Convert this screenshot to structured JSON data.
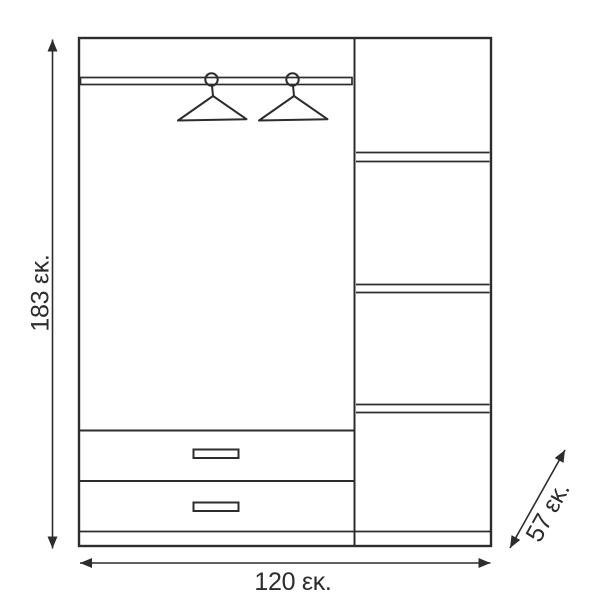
{
  "page": {
    "background_color": "#ffffff",
    "line_color": "#2d2d2d"
  },
  "diagram": {
    "type": "wardrobe-dimension-drawing",
    "labels": {
      "height": "183 εκ.",
      "width": "120 εκ.",
      "depth": "57 εκ."
    },
    "values": {
      "height_cm": 183,
      "width_cm": 120,
      "depth_cm": 57,
      "unit": "εκ."
    },
    "features": {
      "hanger_count": 2,
      "drawer_count": 2,
      "shelf_compartment_count": 4
    },
    "icons": {
      "hanger": "hanger-icon",
      "up_arrow": "▲",
      "down_arrow": "▼",
      "left_arrow": "◀",
      "right_arrow": "▶"
    }
  }
}
